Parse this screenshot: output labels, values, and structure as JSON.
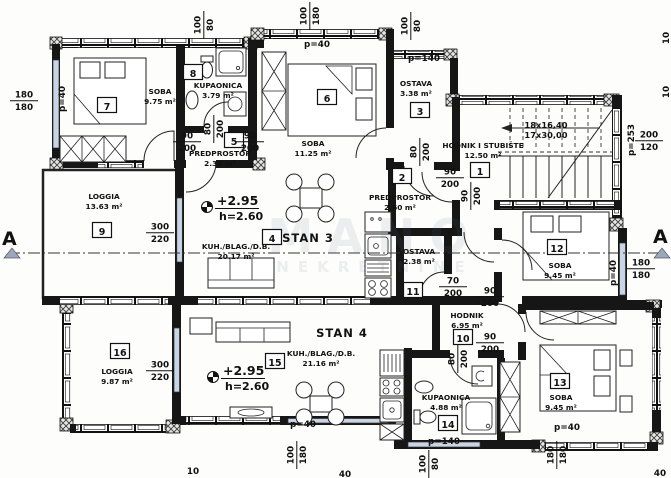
{
  "title": "Floor plan - Stan 3 / Stan 4",
  "watermark": {
    "line1": "MANO",
    "line2": "NEKRETNINE"
  },
  "plan": {
    "apartments": [
      {
        "label": "STAN 3",
        "x": 308,
        "y": 242
      },
      {
        "label": "STAN 4",
        "x": 342,
        "y": 337
      }
    ],
    "rooms": [
      {
        "num": "7",
        "name": "SOBA",
        "area": "9.75 m²",
        "nx": 107,
        "ny": 106,
        "lx": 160,
        "ly": 94
      },
      {
        "num": "8",
        "name": "KUPAONICA",
        "area": "3.79 m²",
        "nx": 193,
        "ny": 73,
        "lx": 218,
        "ly": 88
      },
      {
        "num": "6",
        "name": "SOBA",
        "area": "11.25 m²",
        "nx": 327,
        "ny": 98,
        "lx": 313,
        "ly": 146
      },
      {
        "num": "3",
        "name": "OSTAVA",
        "area": "3.38 m²",
        "nx": 420,
        "ny": 111,
        "lx": 416,
        "ly": 86
      },
      {
        "num": "5",
        "name": "PREDPROSTOR",
        "area": "2.36 m²",
        "nx": 234,
        "ny": 141,
        "lx": 220,
        "ly": 156
      },
      {
        "num": "1",
        "name": "HODNIK I STUBIŠTE",
        "area": "12.50 m²",
        "nx": 480,
        "ny": 171,
        "lx": 483,
        "ly": 148
      },
      {
        "num": "2",
        "name": "PREDPROSTOR",
        "area": "2.60 m²",
        "nx": 402,
        "ny": 177,
        "lx": 400,
        "ly": 200
      },
      {
        "num": "4",
        "name": "KUH./BLAG./D.B.",
        "area": "20.17 m²",
        "nx": 272,
        "ny": 238,
        "lx": 236,
        "ly": 249
      },
      {
        "num": "9",
        "name": "LOGGIA",
        "area": "13.63 m²",
        "nx": 102,
        "ny": 231,
        "lx": 104,
        "ly": 199
      },
      {
        "num": "11",
        "name": "OSTAVA",
        "area": "2.38 m²",
        "nx": 413,
        "ny": 291,
        "lx": 419,
        "ly": 254
      },
      {
        "num": "12",
        "name": "SOBA",
        "area": "9.45 m²",
        "nx": 557,
        "ny": 248,
        "lx": 560,
        "ly": 268
      },
      {
        "num": "16",
        "name": "LOGGIA",
        "area": "9.87 m²",
        "nx": 120,
        "ny": 352,
        "lx": 117,
        "ly": 374
      },
      {
        "num": "15",
        "name": "KUH./BLAG./D.B.",
        "area": "21.16 m²",
        "nx": 275,
        "ny": 362,
        "lx": 321,
        "ly": 356
      },
      {
        "num": "10",
        "name": "HODNIK",
        "area": "6.95 m²",
        "nx": 463,
        "ny": 338,
        "lx": 467,
        "ly": 318
      },
      {
        "num": "13",
        "name": "SOBA",
        "area": "9.45 m²",
        "nx": 560,
        "ny": 382,
        "lx": 561,
        "ly": 400
      },
      {
        "num": "14",
        "name": "KUPAONICA",
        "area": "4.88 m²",
        "nx": 448,
        "ny": 424,
        "lx": 446,
        "ly": 400
      }
    ],
    "levels": [
      {
        "elev": "+2.95",
        "height": "h=2.60",
        "x": 207,
        "y": 207
      },
      {
        "elev": "+2.95",
        "height": "h=2.60",
        "x": 213,
        "y": 377
      }
    ],
    "stairs": {
      "line1": "18x16,40",
      "line2": "17x30,00",
      "x": 546,
      "y": 128
    },
    "sections": [
      {
        "label": "A",
        "x": 2,
        "y": 245,
        "t1": "4,258",
        "t2": "20,258",
        "t3": "12,248"
      },
      {
        "label": "A",
        "x": 653,
        "y": 243,
        "t1": "654,258",
        "t2": "670,258",
        "t3": "662,248"
      }
    ],
    "dims": [
      {
        "a": "100",
        "b": "80",
        "x": 203,
        "y": 25,
        "r": -90
      },
      {
        "a": "180",
        "b": "180",
        "x": 24,
        "y": 100,
        "r": 0
      },
      {
        "a": "p=40",
        "x": 62,
        "y": 99,
        "r": -90
      },
      {
        "a": "100",
        "b": "180",
        "x": 309,
        "y": 16,
        "r": -90
      },
      {
        "a": "p=40",
        "x": 317,
        "y": 44,
        "r": 0
      },
      {
        "a": "100",
        "b": "80",
        "x": 410,
        "y": 26,
        "r": -90
      },
      {
        "a": "p=140",
        "x": 424,
        "y": 58,
        "r": 0
      },
      {
        "a": "90",
        "b": "200",
        "x": 187,
        "y": 141,
        "r": 0
      },
      {
        "a": "90",
        "b": "200",
        "x": 250,
        "y": 141,
        "r": 0
      },
      {
        "a": "80",
        "b": "200",
        "x": 213,
        "y": 129,
        "r": -90
      },
      {
        "a": "90",
        "b": "200",
        "x": 450,
        "y": 177,
        "r": 0
      },
      {
        "a": "80",
        "b": "200",
        "x": 419,
        "y": 152,
        "r": -90
      },
      {
        "a": "90",
        "b": "200",
        "x": 470,
        "y": 196,
        "r": -90
      },
      {
        "a": "200",
        "b": "120",
        "x": 649,
        "y": 140,
        "r": 0
      },
      {
        "a": "p=253",
        "x": 631,
        "y": 140,
        "r": -90
      },
      {
        "a": "180",
        "b": "180",
        "x": 641,
        "y": 268,
        "r": 0
      },
      {
        "a": "p=40",
        "x": 613,
        "y": 273,
        "r": -90
      },
      {
        "a": "300",
        "b": "220",
        "x": 160,
        "y": 232,
        "r": 0
      },
      {
        "a": "300",
        "b": "220",
        "x": 160,
        "y": 370,
        "r": 0
      },
      {
        "a": "70",
        "b": "200",
        "x": 453,
        "y": 286,
        "r": 0
      },
      {
        "a": "90",
        "b": "200",
        "x": 490,
        "y": 296,
        "r": 0
      },
      {
        "a": "90",
        "b": "200",
        "x": 490,
        "y": 342,
        "r": 0
      },
      {
        "a": "80",
        "b": "200",
        "x": 457,
        "y": 359,
        "r": -90
      },
      {
        "a": "p=140",
        "x": 444,
        "y": 441,
        "r": 0
      },
      {
        "a": "100",
        "b": "80",
        "x": 428,
        "y": 464,
        "r": -90
      },
      {
        "a": "100",
        "b": "180",
        "x": 296,
        "y": 455,
        "r": -90
      },
      {
        "a": "p=40",
        "x": 303,
        "y": 424,
        "r": 0
      },
      {
        "a": "180",
        "b": "180",
        "x": 556,
        "y": 455,
        "r": -90
      },
      {
        "a": "p=40",
        "x": 567,
        "y": 427,
        "r": 0
      },
      {
        "a": "10",
        "x": 193,
        "y": 471,
        "r": 0
      },
      {
        "a": "40",
        "x": 345,
        "y": 474,
        "r": 0
      },
      {
        "a": "40",
        "x": 660,
        "y": 473,
        "r": 0
      },
      {
        "a": "10",
        "x": 666,
        "y": 38,
        "r": -90
      },
      {
        "a": "10",
        "x": 666,
        "y": 92,
        "r": -90
      }
    ]
  }
}
